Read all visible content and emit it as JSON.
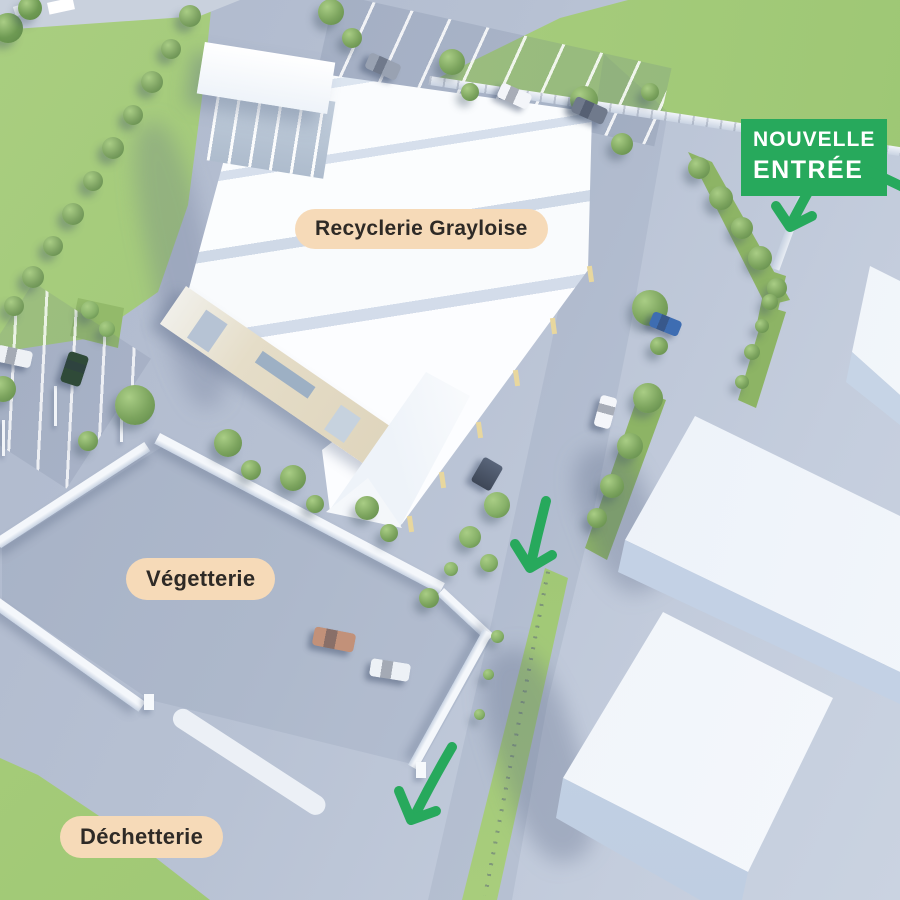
{
  "page": {
    "type": "site-access-plan",
    "site_name": "Recyclerie Grayloise"
  },
  "labels": {
    "recyclerie": "Recyclerie Grayloise",
    "vegetterie": "Végetterie",
    "dechetterie": "Déchetterie"
  },
  "badge": {
    "line1": "NOUVELLE",
    "line2": "ENTRÉE"
  },
  "colors": {
    "accent_green": "#27a95c",
    "label_pill_bg": "#f6dab8",
    "label_text": "#2e2a26",
    "grass": "#a6cb7c",
    "concrete": "#b7c1d3",
    "building_white": "#fbfcfe",
    "neighbor_building": "#e9eff7",
    "facade_beige": "#e2d9c2"
  },
  "arrows": [
    {
      "name": "badge-arrow",
      "direction": "down-left"
    },
    {
      "name": "offscreen-right-arrow",
      "direction": "down-right"
    },
    {
      "name": "mid-road-arrow",
      "direction": "down"
    },
    {
      "name": "bottom-road-arrow",
      "direction": "down-left"
    }
  ],
  "scene": {
    "trees": [
      [
        190,
        16,
        22,
        "#7da262"
      ],
      [
        171,
        49,
        20,
        "#7da262"
      ],
      [
        152,
        82,
        22,
        "#7da262"
      ],
      [
        133,
        115,
        20,
        "#7da262"
      ],
      [
        113,
        148,
        22,
        "#7da262"
      ],
      [
        93,
        181,
        20,
        "#7da262"
      ],
      [
        73,
        214,
        22,
        "#7da262"
      ],
      [
        53,
        246,
        20,
        "#7da262"
      ],
      [
        33,
        277,
        22,
        "#7da262"
      ],
      [
        14,
        306,
        20,
        "#7da262"
      ],
      [
        8,
        28,
        30,
        "#6e9a53"
      ],
      [
        30,
        8,
        24,
        "#6e9a53"
      ],
      [
        331,
        12,
        26
      ],
      [
        352,
        38,
        20
      ],
      [
        452,
        62,
        26
      ],
      [
        470,
        92,
        18
      ],
      [
        584,
        100,
        28
      ],
      [
        622,
        144,
        22
      ],
      [
        650,
        92,
        18
      ],
      [
        699,
        168,
        22
      ],
      [
        721,
        198,
        24
      ],
      [
        742,
        228,
        22
      ],
      [
        760,
        258,
        24
      ],
      [
        777,
        288,
        20
      ],
      [
        770,
        302,
        16
      ],
      [
        762,
        326,
        14
      ],
      [
        752,
        352,
        16
      ],
      [
        742,
        382,
        14
      ],
      [
        650,
        308,
        36
      ],
      [
        659,
        346,
        18
      ],
      [
        648,
        398,
        30
      ],
      [
        630,
        446,
        26
      ],
      [
        612,
        486,
        24
      ],
      [
        597,
        518,
        20
      ],
      [
        497,
        505,
        26,
        "#86b068"
      ],
      [
        470,
        537,
        22,
        "#86b068"
      ],
      [
        489,
        563,
        18,
        "#86b068"
      ],
      [
        451,
        569,
        14,
        "#86b068"
      ],
      [
        90,
        310,
        18,
        "#86b068"
      ],
      [
        107,
        329,
        16,
        "#86b068"
      ],
      [
        135,
        405,
        40
      ],
      [
        88,
        441,
        20
      ],
      [
        3,
        389,
        26
      ],
      [
        228,
        443,
        28
      ],
      [
        251,
        470,
        20
      ],
      [
        293,
        478,
        26
      ],
      [
        315,
        504,
        18
      ],
      [
        367,
        508,
        24
      ],
      [
        389,
        533,
        18
      ],
      [
        429,
        598,
        20
      ],
      [
        497,
        636,
        13,
        "#86b068"
      ],
      [
        488,
        674,
        11,
        "#86b068"
      ],
      [
        479,
        714,
        11,
        "#86b068"
      ]
    ],
    "cars": [
      [
        366,
        58,
        34,
        17,
        24,
        "#99a2b2"
      ],
      [
        498,
        88,
        33,
        16,
        24,
        "#f3f5f9"
      ],
      [
        572,
        102,
        35,
        17,
        24,
        "#707a8c"
      ],
      [
        650,
        316,
        31,
        16,
        22,
        "#3e6db2"
      ],
      [
        597,
        396,
        17,
        32,
        15,
        "#f4f6fa"
      ],
      [
        313,
        630,
        42,
        19,
        11,
        "#c29179"
      ],
      [
        370,
        661,
        40,
        18,
        9,
        "#edf1f6"
      ],
      [
        64,
        353,
        21,
        32,
        18,
        "#2f4a38"
      ],
      [
        -4,
        348,
        36,
        17,
        12,
        "#eef1f5"
      ]
    ]
  }
}
